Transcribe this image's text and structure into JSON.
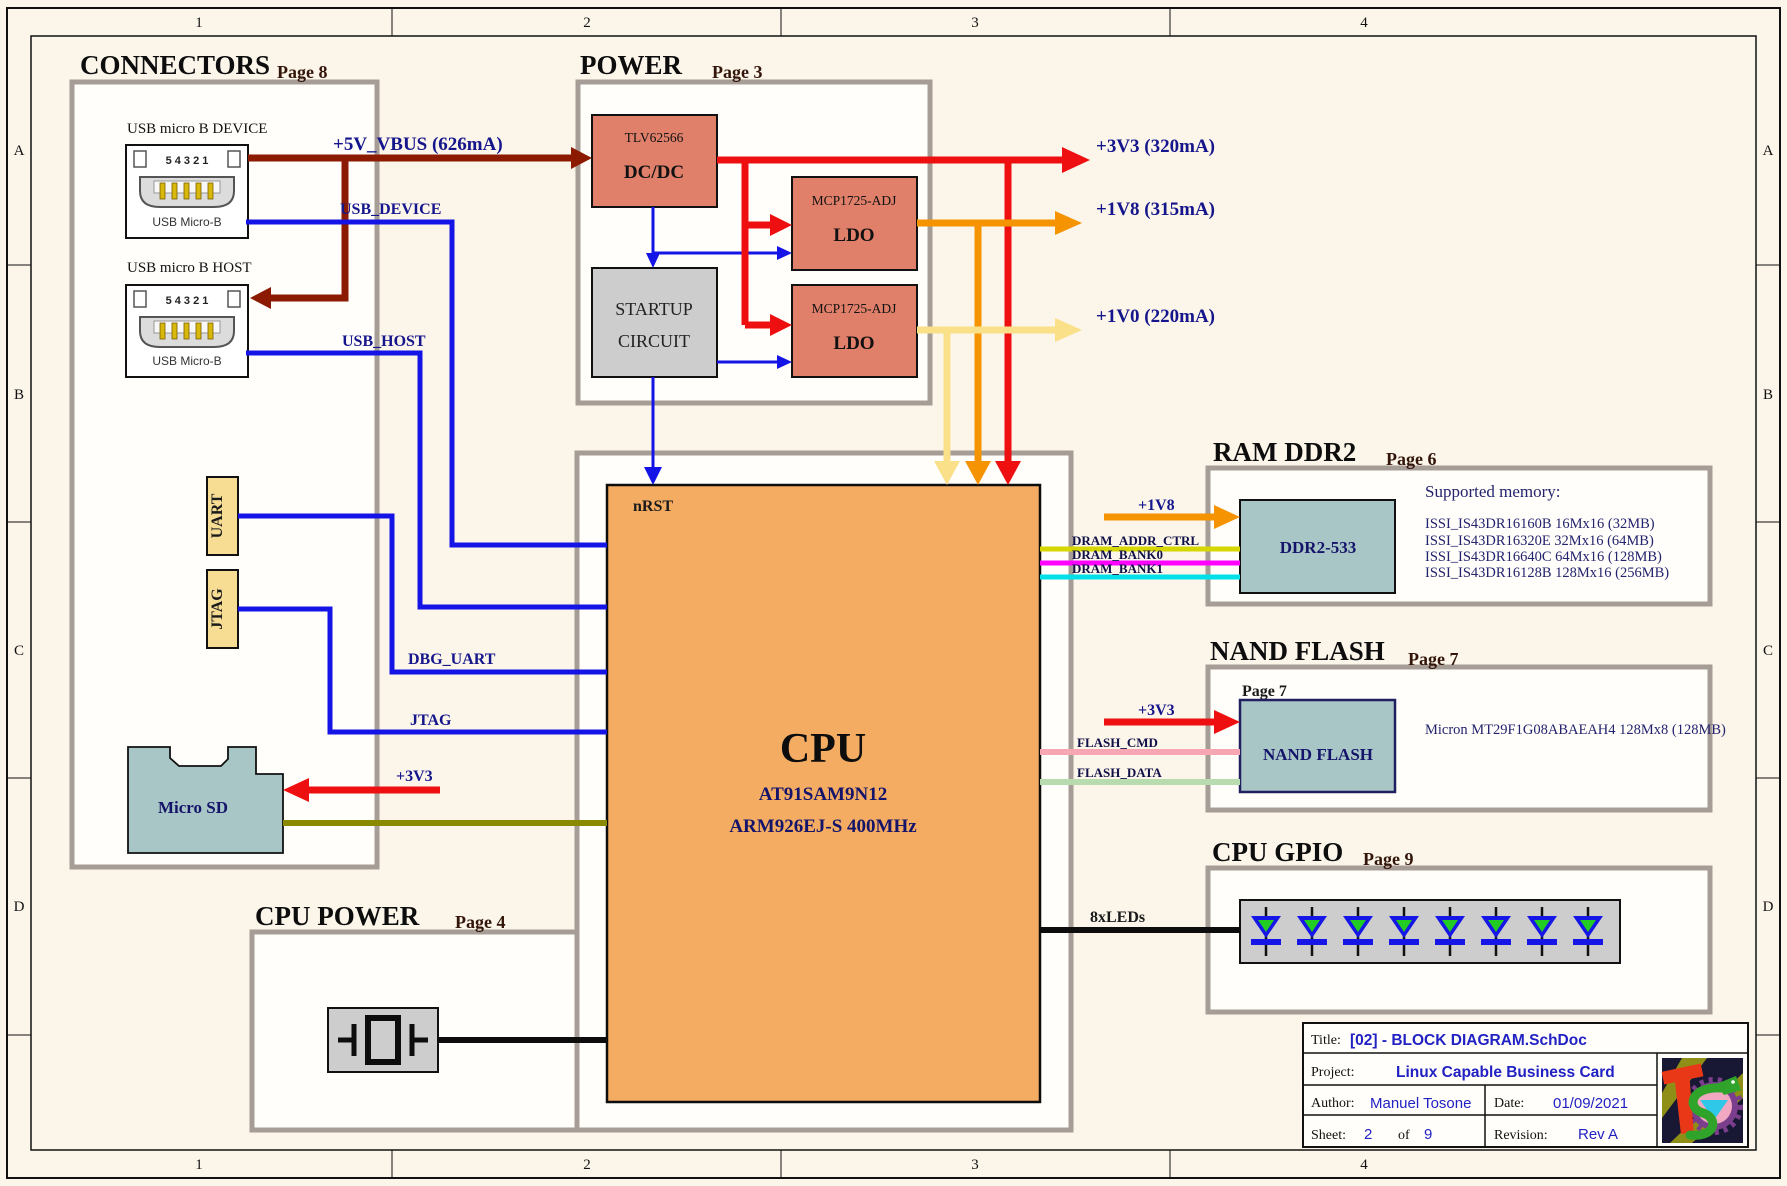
{
  "frame": {
    "columns": [
      "1",
      "2",
      "3",
      "4"
    ],
    "rows": [
      "A",
      "B",
      "C",
      "D"
    ]
  },
  "colors": {
    "vbus_wire": "#8b1a00",
    "signal_wire": "#1414e6",
    "rail_3v3": "#ee1010",
    "rail_1v8": "#f59300",
    "rail_1v0": "#fbe08a",
    "sd_wire": "#8a8a00",
    "dram_addr": "#d6d600",
    "dram_bank0": "#ff00ff",
    "dram_bank1": "#00e0e8",
    "flash_cmd": "#f7a6b4",
    "flash_data": "#b8dcb0",
    "block_salmon": "#e0806a",
    "block_cpu": "#f4ac62",
    "block_teal": "#a9c6c6",
    "box_border": "#a79d97"
  },
  "connectors": {
    "title": "CONNECTORS",
    "page": "Page 8",
    "usb_device": {
      "heading": "USB micro B DEVICE",
      "pins": "5 4 3 2 1",
      "label": "USB Micro-B"
    },
    "usb_host": {
      "heading": "USB micro B HOST",
      "pins": "5 4 3 2 1",
      "label": "USB Micro-B"
    },
    "uart": "UART",
    "jtag": "JTAG",
    "microsd": "Micro SD"
  },
  "power": {
    "title": "POWER",
    "page": "Page 3",
    "dcdc": {
      "part": "TLV62566",
      "label": "DC/DC"
    },
    "startup": {
      "line1": "STARTUP",
      "line2": "CIRCUIT"
    },
    "ldo1": {
      "part": "MCP1725-ADJ",
      "label": "LDO"
    },
    "ldo2": {
      "part": "MCP1725-ADJ",
      "label": "LDO"
    }
  },
  "nets": {
    "vbus": "+5V_VBUS (626mA)",
    "usb_device": "USB_DEVICE",
    "usb_host": "USB_HOST",
    "dbg_uart": "DBG_UART",
    "jtag": "JTAG",
    "rail_3v3": "+3V3 (320mA)",
    "rail_1v8": "+1V8 (315mA)",
    "rail_1v0": "+1V0 (220mA)",
    "p3v3": "+3V3",
    "p1v8": "+1V8",
    "nrst": "nRST",
    "dram_addr": "DRAM_ADDR_CTRL",
    "dram_bank0": "DRAM_BANK0",
    "dram_bank1": "DRAM_BANK1",
    "flash_cmd": "FLASH_CMD",
    "flash_data": "FLASH_DATA",
    "leds": "8xLEDs"
  },
  "cpu": {
    "name": "CPU",
    "part": "AT91SAM9N12",
    "core": "ARM926EJ-S 400MHz"
  },
  "cpu_power": {
    "title": "CPU POWER",
    "page": "Page 4"
  },
  "ram": {
    "title": "RAM DDR2",
    "page": "Page 6",
    "chip": "DDR2-533",
    "supported_heading": "Supported memory:",
    "supported": [
      "ISSI_IS43DR16160B 16Mx16 (32MB)",
      "ISSI_IS43DR16320E 32Mx16 (64MB)",
      "ISSI_IS43DR16640C 64Mx16 (128MB)",
      "ISSI_IS43DR16128B 128Mx16 (256MB)"
    ]
  },
  "nand": {
    "title": "NAND FLASH",
    "page": "Page 7",
    "inner_page": "Page 7",
    "chip": "NAND FLASH",
    "part": "Micron MT29F1G08ABAEAH4 128Mx8 (128MB)"
  },
  "gpio": {
    "title": "CPU GPIO",
    "page": "Page 9"
  },
  "titleblock": {
    "title_label": "Title:",
    "title": "[02] - BLOCK DIAGRAM.SchDoc",
    "project_label": "Project:",
    "project": "Linux Capable Business Card",
    "author_label": "Author:",
    "author": "Manuel Tosone",
    "date_label": "Date:",
    "date": "01/09/2021",
    "sheet_label": "Sheet:",
    "sheet_num": "2",
    "of_label": "of",
    "sheet_total": "9",
    "revision_label": "Revision:",
    "revision": "Rev A"
  }
}
